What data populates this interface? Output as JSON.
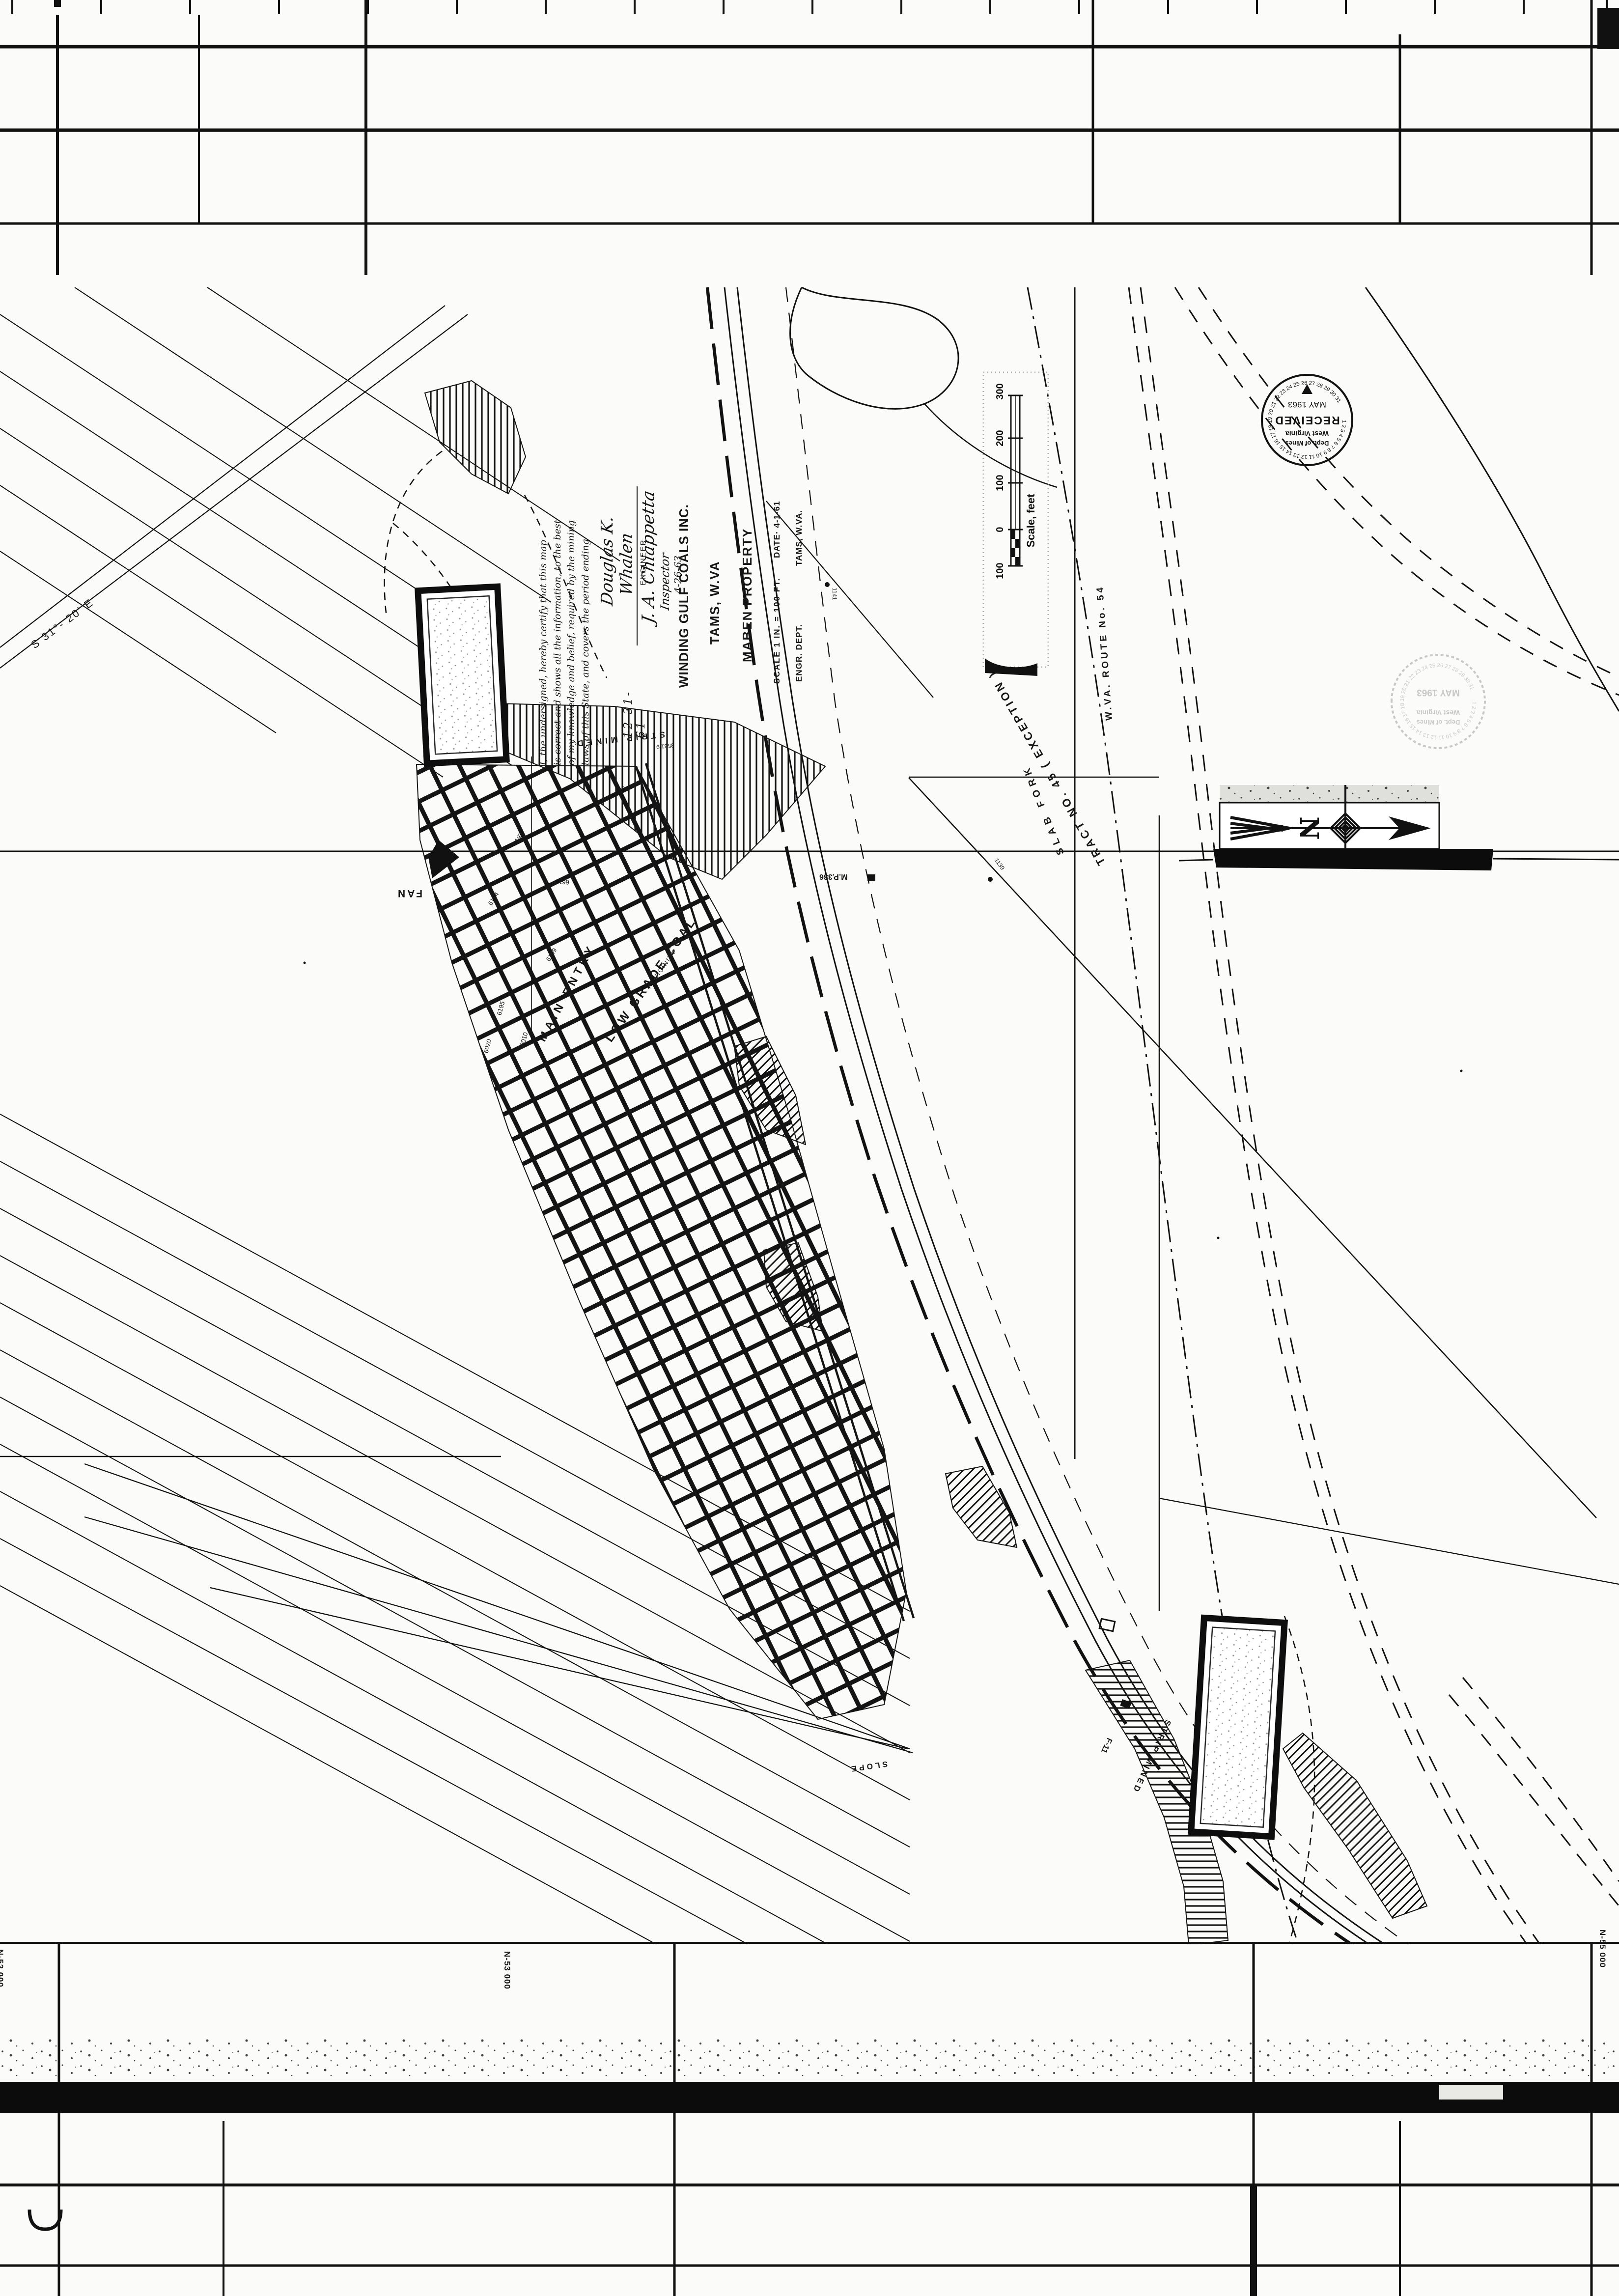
{
  "sheet": {
    "grid_labels": {
      "left": "N-52 000",
      "center": "N-53 000",
      "right": "N-55 000"
    }
  },
  "title_block": {
    "company": "WINDING GULF COALS INC.",
    "location": "TAMS, W.VA",
    "property": "MABEN PROPERTY",
    "scale": "SCALE  1 IN. = 100 FT.",
    "date": "DATE· 4-1-61",
    "dept": "ENGR. DEPT.",
    "dept_location": "TAMS, W.VA."
  },
  "certification": {
    "line1": "I, the undersigned, hereby certify that this map",
    "line2": "is correct and shows all the information, to the best",
    "line3": "of my knowledge and belief, required by the mining",
    "line4": "laws of this State, and covers the period ending",
    "period": "12-31-61",
    "signature": "Douglas K. Whalen",
    "signature_title": "ENGINEER"
  },
  "inspector": {
    "signature": "J. A. Chiappetta",
    "title": "Inspector",
    "date": "4-26-63"
  },
  "scale_bar": {
    "ticks": [
      "100",
      "0",
      "100",
      "200",
      "300"
    ],
    "caption": "Scale, feet"
  },
  "stamp": {
    "received": "RECEIVED",
    "state": "West Virginia",
    "dept": "Dept. of Mines",
    "date": "MAY 1963",
    "ring": "1 2 3 4 5 6 7 8 9 10 11 12 13 14 15 16 17 18 19 20 21 22 23 24 25 26 27 28 29 30 31"
  },
  "stamp_faded": {
    "state": "West Virginia",
    "dept": "Dept. of Mines",
    "date": "MAY 1963"
  },
  "north_arrow": {
    "letter": "N"
  },
  "map_labels": {
    "fan": "FAN",
    "main_entry": "MAIN ENTRY",
    "low_grade_coal": "LOW GRADE COAL",
    "vicinity_note": "IN VICINITY",
    "slab_fork": "SLAB  FORK",
    "tract": "TRACT  NO. 45  ( EXCEPTION )",
    "route": "W.VA. ROUTE  No. 54",
    "bearing": "S 31°- 20' E",
    "bearing2": "25-15",
    "mile_post": "M.P.336",
    "strip_mined_1": "STRIP MINED",
    "strip_mined_2": "STRIP MINED",
    "slope": "SLOPE",
    "f11": "F-11",
    "survey_note": "3531.9"
  },
  "pole_numbers": [
    "1141",
    "1139"
  ],
  "elevations": [
    "6197",
    "6194",
    "6610",
    "6199",
    "6195",
    "6020",
    "6010"
  ]
}
